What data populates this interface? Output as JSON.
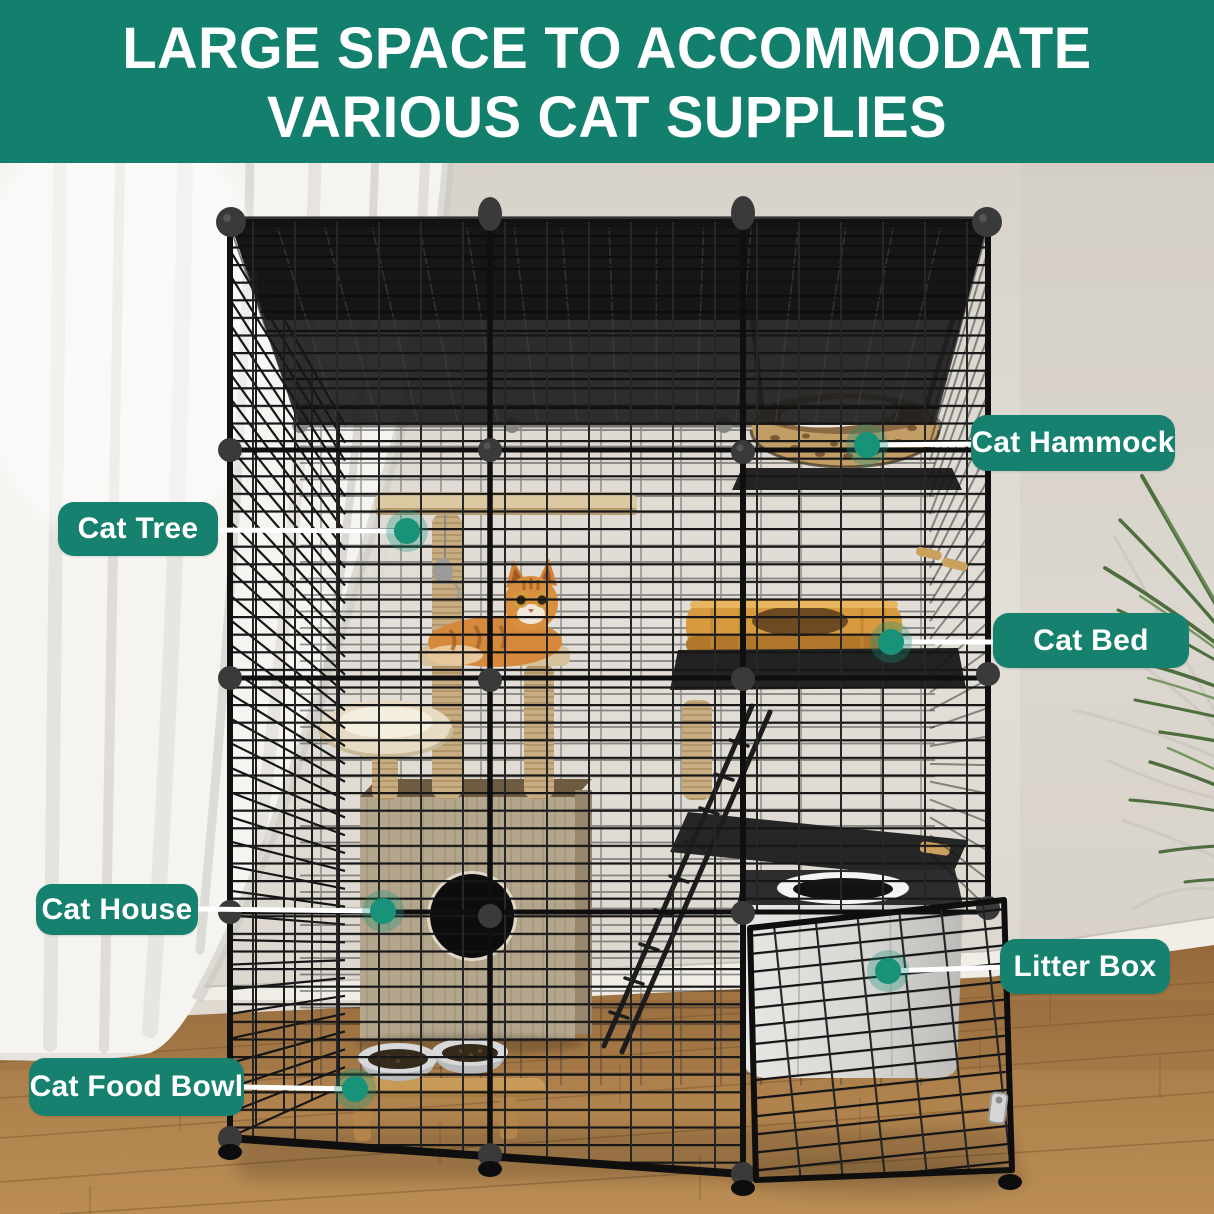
{
  "header": {
    "line1": "LARGE SPACE TO ACCOMMODATE",
    "line2": "VARIOUS CAT SUPPLIES",
    "bg_color": "#13806e",
    "text_color": "#ffffff"
  },
  "callouts": [
    {
      "id": "cat-tree",
      "label": "Cat Tree",
      "box": {
        "x": 58,
        "y": 502,
        "w": 160,
        "h": 54
      },
      "line": {
        "x1": 214,
        "y1": 530,
        "x2": 407,
        "y2": 531
      },
      "dot": {
        "x": 407,
        "y": 531
      }
    },
    {
      "id": "cat-hammock",
      "label": "Cat Hammock",
      "box": {
        "x": 971,
        "y": 415,
        "w": 204,
        "h": 56
      },
      "line": {
        "x1": 867,
        "y1": 445,
        "x2": 980,
        "y2": 444
      },
      "dot": {
        "x": 867,
        "y": 445
      }
    },
    {
      "id": "cat-bed",
      "label": "Cat Bed",
      "box": {
        "x": 993,
        "y": 613,
        "w": 196,
        "h": 55
      },
      "line": {
        "x1": 891,
        "y1": 642,
        "x2": 999,
        "y2": 642
      },
      "dot": {
        "x": 891,
        "y": 642
      }
    },
    {
      "id": "cat-house",
      "label": "Cat House",
      "box": {
        "x": 36,
        "y": 884,
        "w": 162,
        "h": 51
      },
      "line": {
        "x1": 195,
        "y1": 909,
        "x2": 383,
        "y2": 911
      },
      "dot": {
        "x": 383,
        "y": 911
      }
    },
    {
      "id": "litter-box",
      "label": "Litter Box",
      "box": {
        "x": 1000,
        "y": 939,
        "w": 170,
        "h": 55
      },
      "line": {
        "x1": 888,
        "y1": 971,
        "x2": 1006,
        "y2": 967
      },
      "dot": {
        "x": 888,
        "y": 971
      }
    },
    {
      "id": "cat-food-bowl",
      "label": "Cat Food Bowl",
      "box": {
        "x": 29,
        "y": 1058,
        "w": 215,
        "h": 58
      },
      "line": {
        "x1": 241,
        "y1": 1087,
        "x2": 355,
        "y2": 1089
      },
      "dot": {
        "x": 355,
        "y": 1089
      }
    }
  ],
  "style": {
    "accent": "#16816f",
    "dot_color": "#189278",
    "line_color": "#ffffff"
  },
  "scene": {
    "objects": [
      "wire cat cage",
      "cat tree",
      "tabby cat",
      "cat hammock",
      "cat bed",
      "cat house",
      "litter box",
      "cat food bowls",
      "white curtain",
      "potted plant",
      "wood floor"
    ]
  }
}
